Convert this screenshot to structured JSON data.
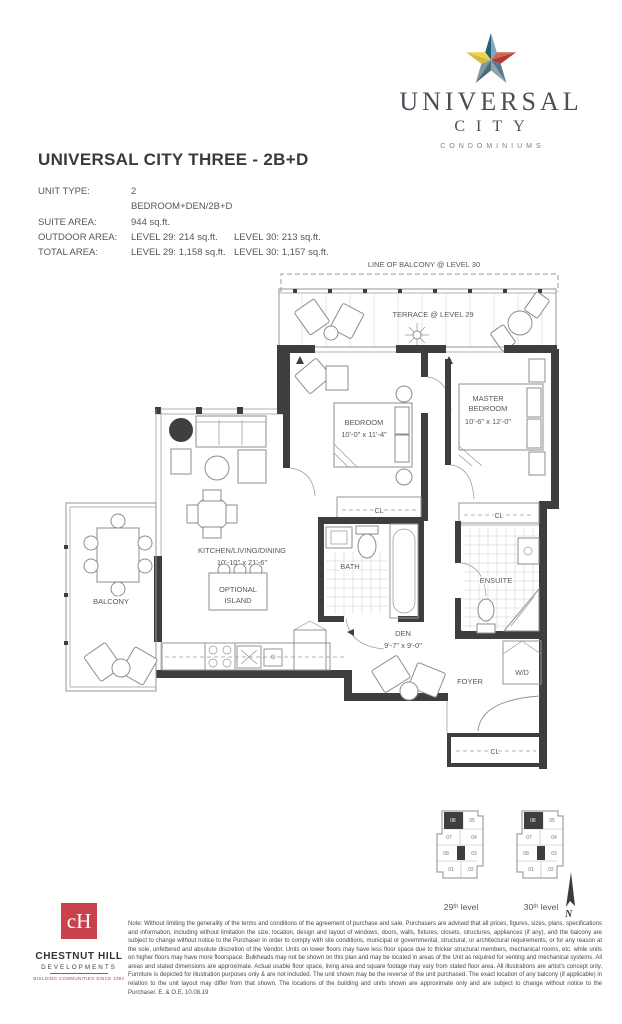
{
  "brand": {
    "name": "UNIVERSAL",
    "city": "CITY",
    "condominiums": "CONDOMINIUMS",
    "star_colors": {
      "blue_dark": "#205e79",
      "blue_light": "#7fa9bc",
      "red_light": "#d4684f",
      "red_dark": "#b03a2f",
      "slate_dark": "#5b7888",
      "slate_light": "#8ba4b0",
      "teal_dark": "#4f6c7c",
      "teal_light": "#7e98a5",
      "yellow_dark": "#d8b93f",
      "yellow_light": "#ecd44e"
    }
  },
  "header": {
    "title": "UNIVERSAL CITY THREE - 2B+D"
  },
  "specs": {
    "rows": [
      {
        "label": "UNIT TYPE:",
        "value": "2 BEDROOM+DEN/2B+D",
        "value2": ""
      },
      {
        "label": "SUITE AREA:",
        "value": "944 sq.ft.",
        "value2": ""
      },
      {
        "label": "OUTDOOR AREA:",
        "value": "LEVEL 29: 214 sq.ft.",
        "value2": "LEVEL 30: 213 sq.ft."
      },
      {
        "label": "TOTAL AREA:",
        "value": "LEVEL 29: 1,158 sq.ft.",
        "value2": "LEVEL 30: 1,157 sq.ft."
      }
    ]
  },
  "plan": {
    "line_of_balcony": "LINE OF BALCONY @ LEVEL 30",
    "terrace": "TERRACE @ LEVEL 29",
    "bedroom": {
      "name": "BEDROOM",
      "dims": "10'-0\" x 11'-4\""
    },
    "master_bedroom": {
      "name_line1": "MASTER",
      "name_line2": "BEDROOM",
      "dims": "10'-6\" x 12'-0\""
    },
    "kitchen_living_dining": {
      "name": "KITCHEN/LIVING/DINING",
      "dims": "10'-10\" x 21'-6\""
    },
    "optional_island": {
      "line1": "OPTIONAL",
      "line2": "ISLAND"
    },
    "den": {
      "name": "DEN",
      "dims": "9'-7\" x 9'-0\""
    },
    "bath": "BATH",
    "ensuite": "ENSUITE",
    "balcony": "BALCONY",
    "foyer": "FOYER",
    "closet": "CL",
    "washer_dryer": "W/D"
  },
  "keyplan": {
    "units": [
      "06",
      "05",
      "07",
      "04",
      "08",
      "03",
      "01",
      "02"
    ],
    "highlighted_unit": "06",
    "levels": [
      "29ᵗʰ level",
      "30ᵗʰ level"
    ]
  },
  "compass": {
    "label": "N"
  },
  "developer": {
    "name": "CHESTNUT HILL",
    "sub": "DEVELOPMENTS",
    "tagline": "BUILDING COMMUNITIES SINCE 1981",
    "brand_red": "#c8414b"
  },
  "footnote": "Note: Without limiting the generality of the terms and conditions of the agreement of purchase and sale, Purchasers are advised that all prices, figures, sizes, plans, specifications and information, including without limitation the size, location, design and layout of windows, doors, walls, fixtures, closets, structures, appliances (if any), and the balcony are subject to change without notice to the Purchaser in order to comply with site conditions, municipal or governmental, structural, or architectural requirements, or for any reason at the sole, unfettered and absolute discretion of the Vendor. Units on lower floors may have less floor space due to thicker structural members, mechanical rooms, etc. while units on higher floors may have more floorspace. Bulkheads may not be shown on this plan and may be located in areas of the Unit as required for venting and mechanical systems. All areas and stated dimensions are approximate. Actual usable floor space, living area and square footage may vary from stated floor area. All illustrations are artist's concept only. Furniture is depicted for illustration purposes only & are not included. The unit shown may be the reverse of the unit purchased. The exact location of any balcony (if applicable) in relation to the unit layout may differ from that shown. The locations of the building and units shown are approximate only and are subject to change without notice to the Purchaser. E. & O.E. 10.08.19"
}
